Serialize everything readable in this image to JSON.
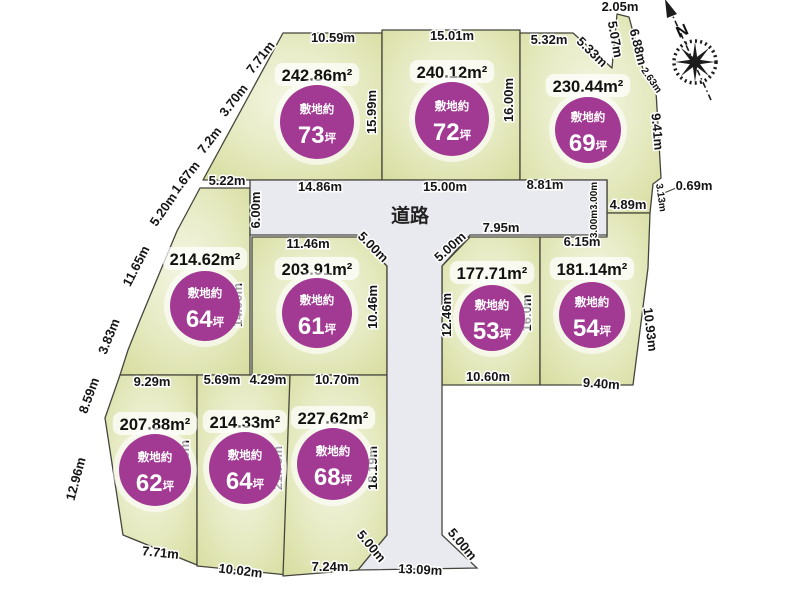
{
  "colors": {
    "plot_edge": "#d6dc9d",
    "plot_mid": "#e7ebc4",
    "plot_center": "#f4f6e3",
    "outline": "#45453c",
    "road_fill": "#e9eaef",
    "badge_fill": "#a23a94",
    "badge_text": "#ffffff",
    "dim_text": "#151515"
  },
  "road": {
    "label": "道路"
  },
  "compass": {
    "label": "N"
  },
  "badge_prefix": "敷地約",
  "tsubo_unit": "坪",
  "plots": [
    {
      "id": "73",
      "area_label": "242.86m²",
      "tsubo": "73",
      "poly": "283,33 382,33 382,180 203,180",
      "area_pos": [
        317,
        79
      ],
      "circle": [
        317,
        122,
        37
      ]
    },
    {
      "id": "72",
      "area_label": "240.12m²",
      "tsubo": "72",
      "poly": "382,30 520,30 520,180 382,180",
      "area_pos": [
        452,
        76
      ],
      "circle": [
        452,
        119,
        37
      ]
    },
    {
      "id": "69",
      "area_label": "230.44m²",
      "tsubo": "69",
      "poly": "520,33 573,33 612,68 617,14 629,17 644,73 656,91 661,178 653,184 650,213 607,213 607,180 520,180",
      "area_pos": [
        588,
        90
      ],
      "circle": [
        588,
        130,
        33
      ]
    },
    {
      "id": "64",
      "area_label": "214.62m²",
      "tsubo": "64",
      "poly": "200,188 250,188 250,375 120,375 128,350 140,320 177,231",
      "area_pos": [
        205,
        263
      ],
      "circle": [
        205,
        306,
        35
      ]
    },
    {
      "id": "61",
      "area_label": "203.91m²",
      "tsubo": "61",
      "poly": "252,237 357,237 387,266 387,375 252,375",
      "area_pos": [
        317,
        273
      ],
      "circle": [
        317,
        313,
        35
      ]
    },
    {
      "id": "53",
      "area_label": "177.71m²",
      "tsubo": "53",
      "poly": "470,237 540,237 540,385 442,385 442,266",
      "area_pos": [
        492,
        277
      ],
      "circle": [
        492,
        318,
        33
      ]
    },
    {
      "id": "54",
      "area_label": "181.14m²",
      "tsubo": "54",
      "poly": "540,237 607,237 607,213 650,213 648,268 633,385 540,385",
      "area_pos": [
        592,
        273
      ],
      "circle": [
        592,
        315,
        33
      ]
    },
    {
      "id": "62",
      "area_label": "207.88m²",
      "tsubo": "62",
      "poly": "120,375 197,375 197,565 123,535 105,418",
      "area_pos": [
        155,
        428
      ],
      "circle": [
        155,
        470,
        36
      ]
    },
    {
      "id": "64b",
      "area_label": "214.33m²",
      "tsubo": "64",
      "poly": "197,375 290,375 288,575 197,566",
      "area_pos": [
        245,
        426
      ],
      "circle": [
        245,
        468,
        36
      ]
    },
    {
      "id": "68",
      "area_label": "227.62m²",
      "tsubo": "68",
      "poly": "290,375 387,375 387,535 358,570 283,576",
      "area_pos": [
        333,
        422
      ],
      "circle": [
        333,
        464,
        36
      ]
    }
  ],
  "road_poly": "250,180 607,180 607,235 470,235 442,266 442,535 477,568 358,570 387,535 387,266 357,235 250,235",
  "road_label_pos": [
    410,
    222
  ],
  "dimensions": [
    {
      "t": "10.59m",
      "x": 333,
      "y": 42,
      "r": 0
    },
    {
      "t": "15.01m",
      "x": 452,
      "y": 40,
      "r": 0
    },
    {
      "t": "5.32m",
      "x": 549,
      "y": 44,
      "r": 0
    },
    {
      "t": "2.05m",
      "x": 620,
      "y": 11,
      "r": 0
    },
    {
      "t": "7.71m",
      "x": 264,
      "y": 60,
      "r": -52
    },
    {
      "t": "3.70m",
      "x": 237,
      "y": 103,
      "r": -52
    },
    {
      "t": "7.2m",
      "x": 213,
      "y": 143,
      "r": -52
    },
    {
      "t": "1.67m",
      "x": 189,
      "y": 180,
      "r": -52
    },
    {
      "t": "5.20m",
      "x": 167,
      "y": 212,
      "r": -55
    },
    {
      "t": "11.65m",
      "x": 140,
      "y": 268,
      "r": -63
    },
    {
      "t": "3.83m",
      "x": 113,
      "y": 338,
      "r": -68
    },
    {
      "t": "8.59m",
      "x": 93,
      "y": 397,
      "r": -70
    },
    {
      "t": "12.96m",
      "x": 80,
      "y": 480,
      "r": -75
    },
    {
      "t": "5.33m",
      "x": 589,
      "y": 55,
      "r": 44
    },
    {
      "t": "5.07m",
      "x": 611,
      "y": 40,
      "r": 80
    },
    {
      "t": "6.88m",
      "x": 634,
      "y": 48,
      "r": 76
    },
    {
      "t": "2.63m",
      "x": 649,
      "y": 82,
      "r": 55,
      "small": true
    },
    {
      "t": "9.41m",
      "x": 653,
      "y": 132,
      "r": 85
    },
    {
      "t": "0.69m",
      "x": 694,
      "y": 190,
      "r": 0
    },
    {
      "t": "3.13m",
      "x": 658,
      "y": 198,
      "r": 82,
      "small": true
    },
    {
      "t": "15.99m",
      "x": 376,
      "y": 112,
      "r": -90
    },
    {
      "t": "16.00m",
      "x": 513,
      "y": 100,
      "r": -90
    },
    {
      "t": "14.86m",
      "x": 320,
      "y": 191,
      "r": 0
    },
    {
      "t": "15.00m",
      "x": 445,
      "y": 191,
      "r": 0
    },
    {
      "t": "8.81m",
      "x": 545,
      "y": 189,
      "r": 0
    },
    {
      "t": "6.00m",
      "x": 260,
      "y": 210,
      "r": -90
    },
    {
      "t": "3.00m",
      "x": 597,
      "y": 196,
      "r": -90,
      "small": true
    },
    {
      "t": "3.00m",
      "x": 597,
      "y": 224,
      "r": -90,
      "small": true
    },
    {
      "t": "4.89m",
      "x": 628,
      "y": 209,
      "r": 0
    },
    {
      "t": "5.22m",
      "x": 227,
      "y": 185,
      "r": 0
    },
    {
      "t": "11.46m",
      "x": 308,
      "y": 248,
      "r": 0
    },
    {
      "t": "5.00m",
      "x": 370,
      "y": 250,
      "r": 45
    },
    {
      "t": "5.00m",
      "x": 453,
      "y": 250,
      "r": -42
    },
    {
      "t": "7.95m",
      "x": 501,
      "y": 232,
      "r": 0
    },
    {
      "t": "6.15m",
      "x": 582,
      "y": 246,
      "r": 0
    },
    {
      "t": "14.00m",
      "x": 242,
      "y": 305,
      "r": -90
    },
    {
      "t": "10.46m",
      "x": 377,
      "y": 307,
      "r": -90
    },
    {
      "t": "12.46m",
      "x": 451,
      "y": 315,
      "r": -90
    },
    {
      "t": "16.0m",
      "x": 531,
      "y": 313,
      "r": -90
    },
    {
      "t": "10.93m",
      "x": 646,
      "y": 330,
      "r": 83
    },
    {
      "t": "9.29m",
      "x": 152,
      "y": 386,
      "r": 0
    },
    {
      "t": "5.69m",
      "x": 222,
      "y": 384,
      "r": 0
    },
    {
      "t": "4.29m",
      "x": 268,
      "y": 384,
      "r": 0
    },
    {
      "t": "10.70m",
      "x": 337,
      "y": 384,
      "r": 0
    },
    {
      "t": "10.60m",
      "x": 488,
      "y": 381,
      "r": 0
    },
    {
      "t": "9.40m",
      "x": 601,
      "y": 388,
      "r": 4
    },
    {
      "t": "21.10m",
      "x": 189,
      "y": 462,
      "r": -90
    },
    {
      "t": "21.75m",
      "x": 282,
      "y": 468,
      "r": -90
    },
    {
      "t": "18.19m",
      "x": 377,
      "y": 468,
      "r": -90
    },
    {
      "t": "7.71m",
      "x": 160,
      "y": 557,
      "r": 6
    },
    {
      "t": "10.02m",
      "x": 240,
      "y": 575,
      "r": 7
    },
    {
      "t": "7.24m",
      "x": 330,
      "y": 571,
      "r": 0
    },
    {
      "t": "5.00m",
      "x": 368,
      "y": 549,
      "r": 50
    },
    {
      "t": "5.00m",
      "x": 459,
      "y": 547,
      "r": 50
    },
    {
      "t": "13.09m",
      "x": 420,
      "y": 574,
      "r": 3
    }
  ]
}
